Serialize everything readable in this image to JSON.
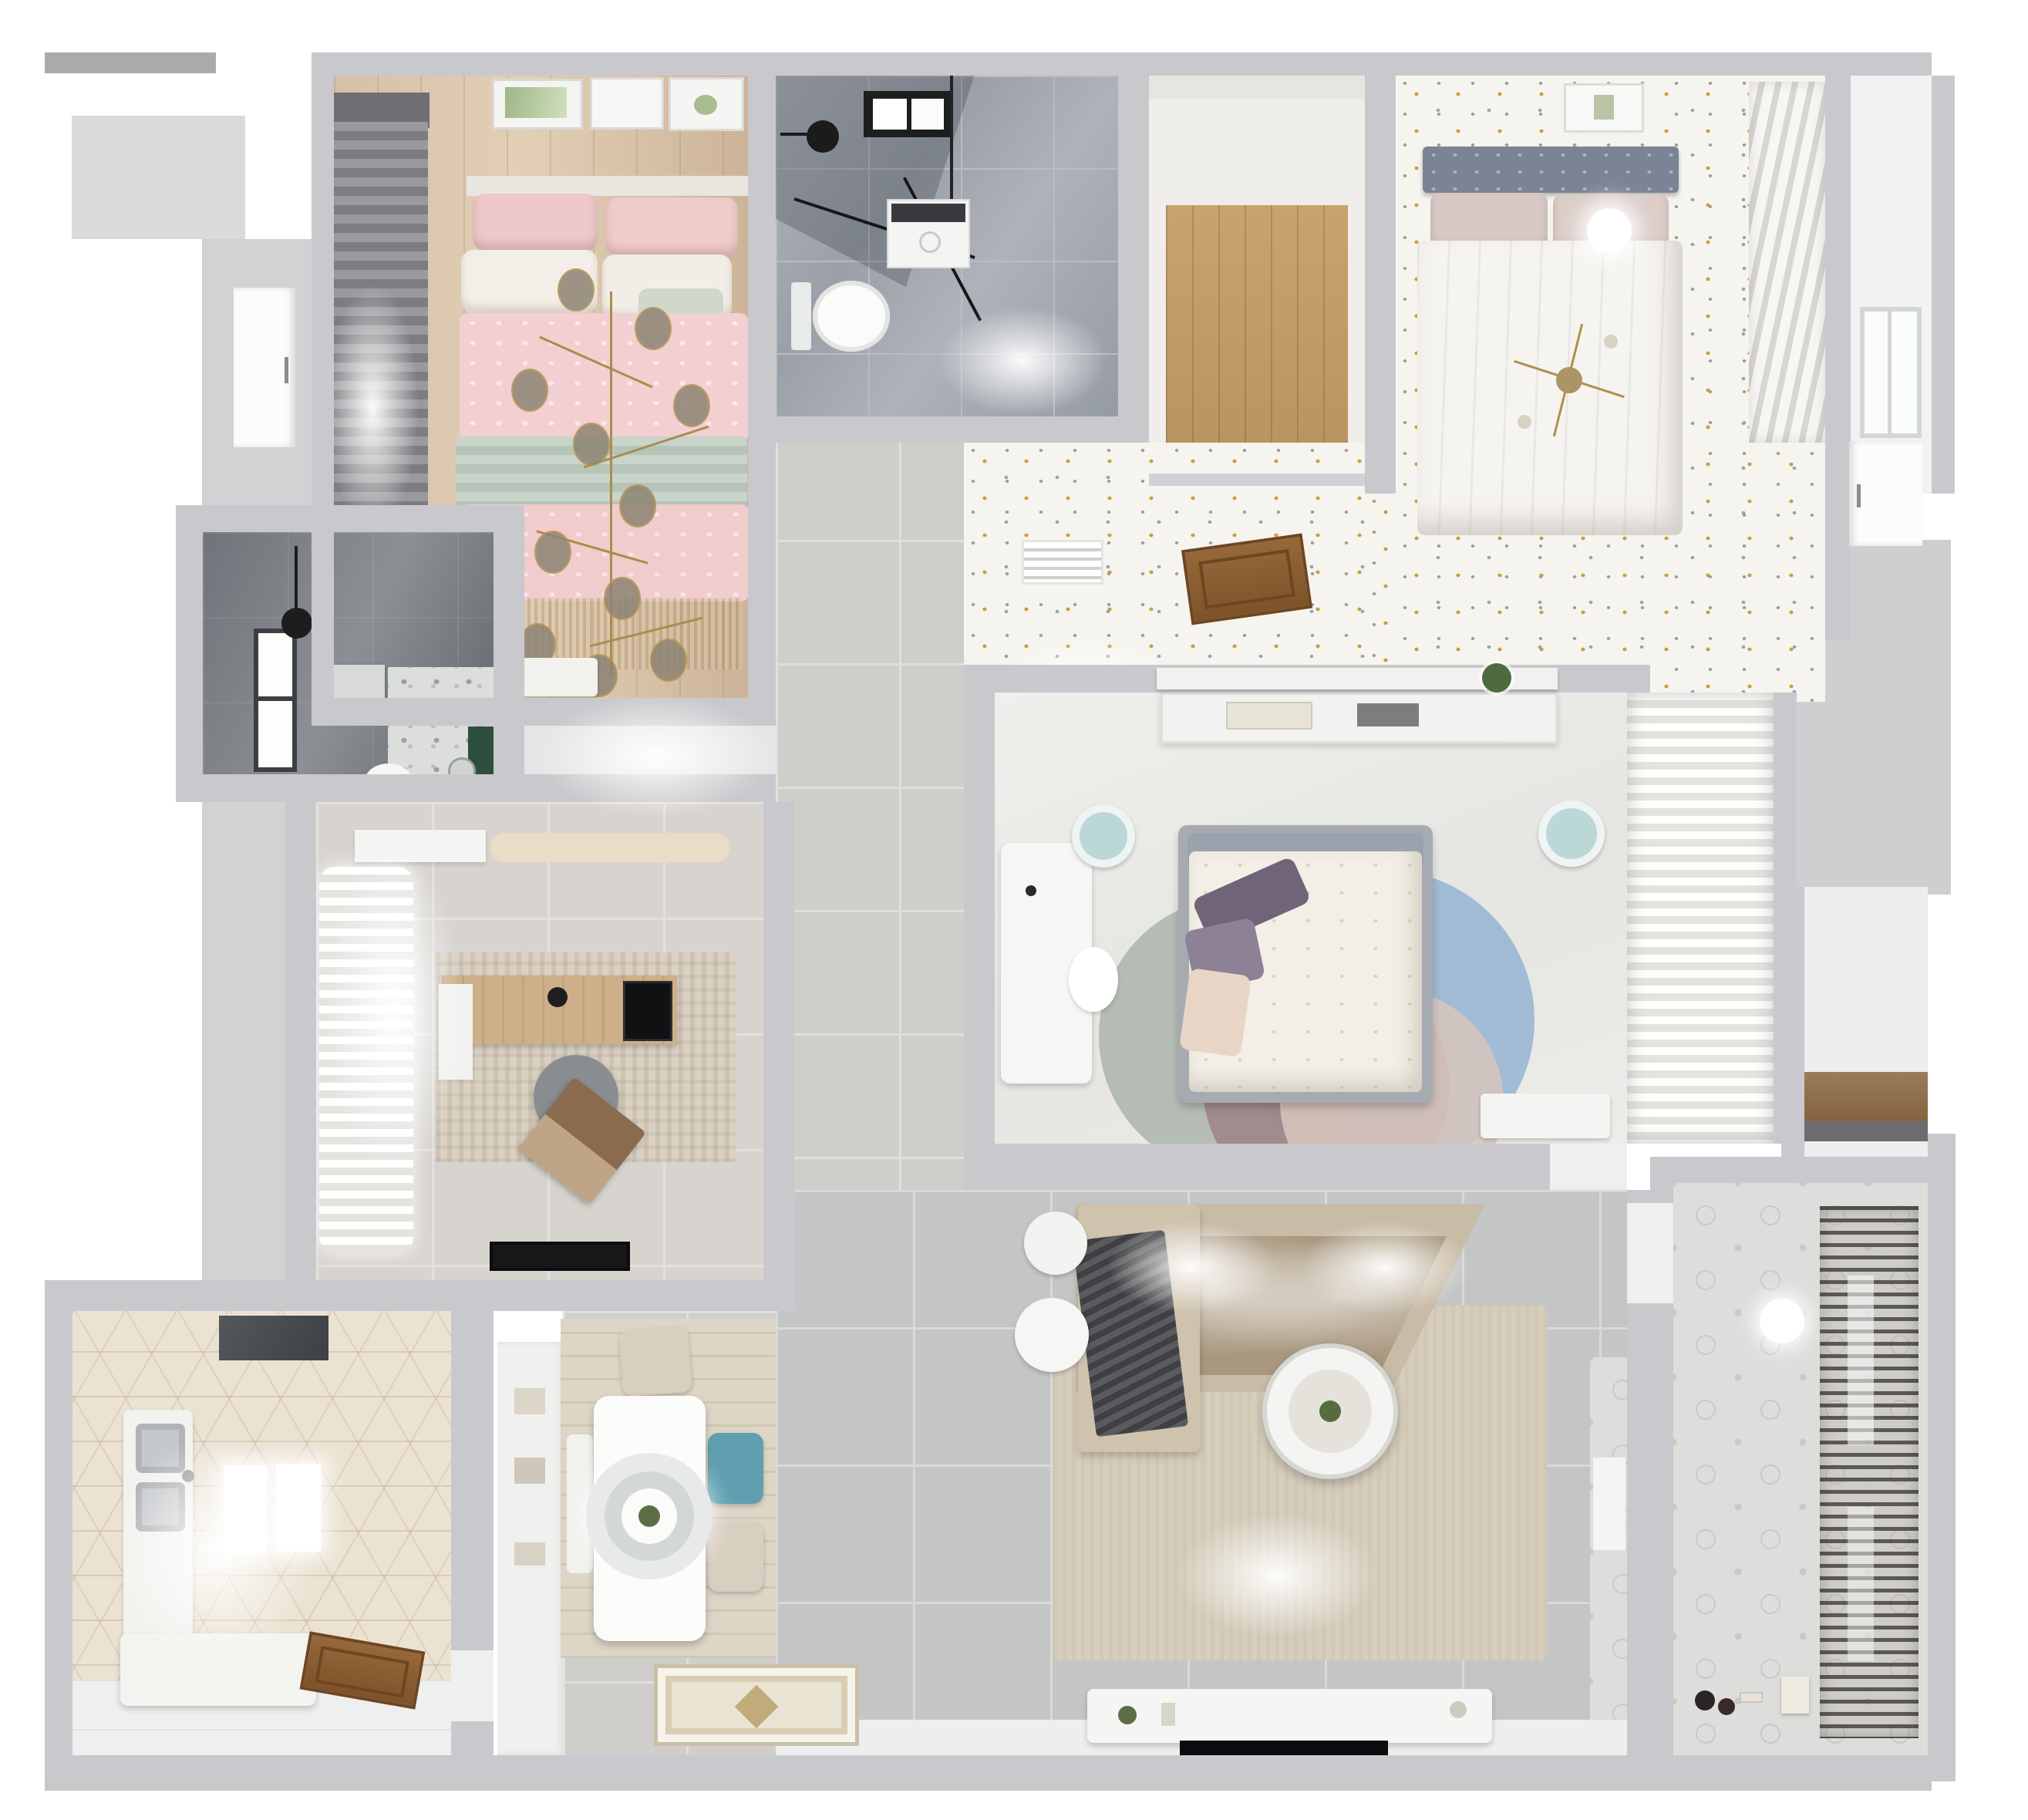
{
  "scene": {
    "type": "3d-floorplan-render",
    "view": "top-down dollhouse",
    "background": "#ffffff",
    "text_visible": false
  },
  "palette": {
    "wall": "#c9c9cd",
    "tile_gray": "#c4c6c6",
    "tile_warm": "#d0cecb",
    "wood_floor": "#d5c0a5",
    "closet_wood": "#c9a36e",
    "marble_bath": "#9ba0a8",
    "dark_bath_tile": "#70747a",
    "speckle_floor": "#f6f4ef",
    "hex_kitchen": "#ebe2d2",
    "pink_bedding": "#f2cfd0",
    "sage_throw": "#c3cfc4",
    "teal_chair": "#5f9fb0",
    "rug_blue": "#8fb0d0",
    "rug_mauve": "#9b8084",
    "gold_fixture": "#b08f4a",
    "sofa_beige": "#c9bca7",
    "blanket_gray": "#4e4f52",
    "door_wood": "#8a5a2f"
  },
  "rooms": [
    {
      "id": "bedroom-1",
      "label": "Bedroom with pink bedding",
      "furniture": [
        "double-bed",
        "pink-pillows",
        "white-pillows",
        "sage-throw",
        "branch-chandelier",
        "gray-curtains",
        "wall-art-frames",
        "dresser",
        "wood-floor"
      ]
    },
    {
      "id": "bathroom-1",
      "label": "Shower bathroom",
      "furniture": [
        "walk-in-shower",
        "rain-shower-head",
        "black-window",
        "washing-machine",
        "toilet",
        "marble-floor"
      ]
    },
    {
      "id": "walk-in-closet",
      "label": "Walk-in closet",
      "furniture": [
        "wood-floor"
      ]
    },
    {
      "id": "bedroom-2",
      "label": "Bedroom with gray headboard",
      "furniture": [
        "double-bed",
        "gray-headboard",
        "blush-pillows",
        "white-duvet",
        "sputnik-chandelier",
        "ceiling-light",
        "wall-art",
        "louver-closet",
        "speckled-floor"
      ]
    },
    {
      "id": "hallway-top",
      "label": "Hallway with speckled floor",
      "furniture": [
        "floor-vent",
        "open-wood-door",
        "console-half-wall",
        "potted-plant"
      ]
    },
    {
      "id": "bedroom-3",
      "label": "Master bedroom",
      "furniture": [
        "double-bed",
        "floral-duvet",
        "purple-pillows",
        "headboard-shelf",
        "books",
        "white-desk",
        "two-stools",
        "round-layered-rug",
        "sheer-curtain-closet",
        "dresser"
      ]
    },
    {
      "id": "bathroom-2",
      "label": "Dark-tiled bathroom",
      "furniture": [
        "window",
        "black-pendant-lamp",
        "shower-tray",
        "toilet",
        "green-vanity",
        "round-mirror",
        "terrazzo-floor"
      ]
    },
    {
      "id": "study",
      "label": "Study",
      "furniture": [
        "sheer-curtains",
        "wood-desk",
        "gray-office-chair",
        "laptop",
        "distressed-rug",
        "bench",
        "cabinet",
        "black-doormat"
      ]
    },
    {
      "id": "kitchen",
      "label": "Kitchen",
      "furniture": [
        "range-hood",
        "side-counter",
        "double-sink",
        "island-counter",
        "lit-counters",
        "wood-door",
        "hex-tile-floor",
        "left-windows"
      ]
    },
    {
      "id": "dining",
      "label": "Dining area",
      "furniture": [
        "white-dining-table",
        "round-pendant-lamp",
        "beige-chairs",
        "teal-chair",
        "bench",
        "wood-rug",
        "shelf-unit"
      ]
    },
    {
      "id": "living-room",
      "label": "Living room",
      "furniture": [
        "corner-sofa",
        "gray-blanket",
        "beige-rug",
        "round-coffee-table",
        "white-poufs",
        "tv-console",
        "tv",
        "entry-mat",
        "patterned-strip"
      ]
    },
    {
      "id": "storage-niche",
      "label": "Storage niche",
      "furniture": [
        "wood-shelf"
      ]
    },
    {
      "id": "balcony",
      "label": "Balcony / laundry",
      "furniture": [
        "drying-rack",
        "patterned-tile-floor",
        "ceiling-lamp",
        "toys",
        "storage-box"
      ]
    }
  ],
  "doors": [
    "left-exterior-door",
    "hall-open-wood-door",
    "bedroom-3-door-gap",
    "kitchen-wood-door",
    "balcony-door-gap",
    "right-side-door"
  ]
}
